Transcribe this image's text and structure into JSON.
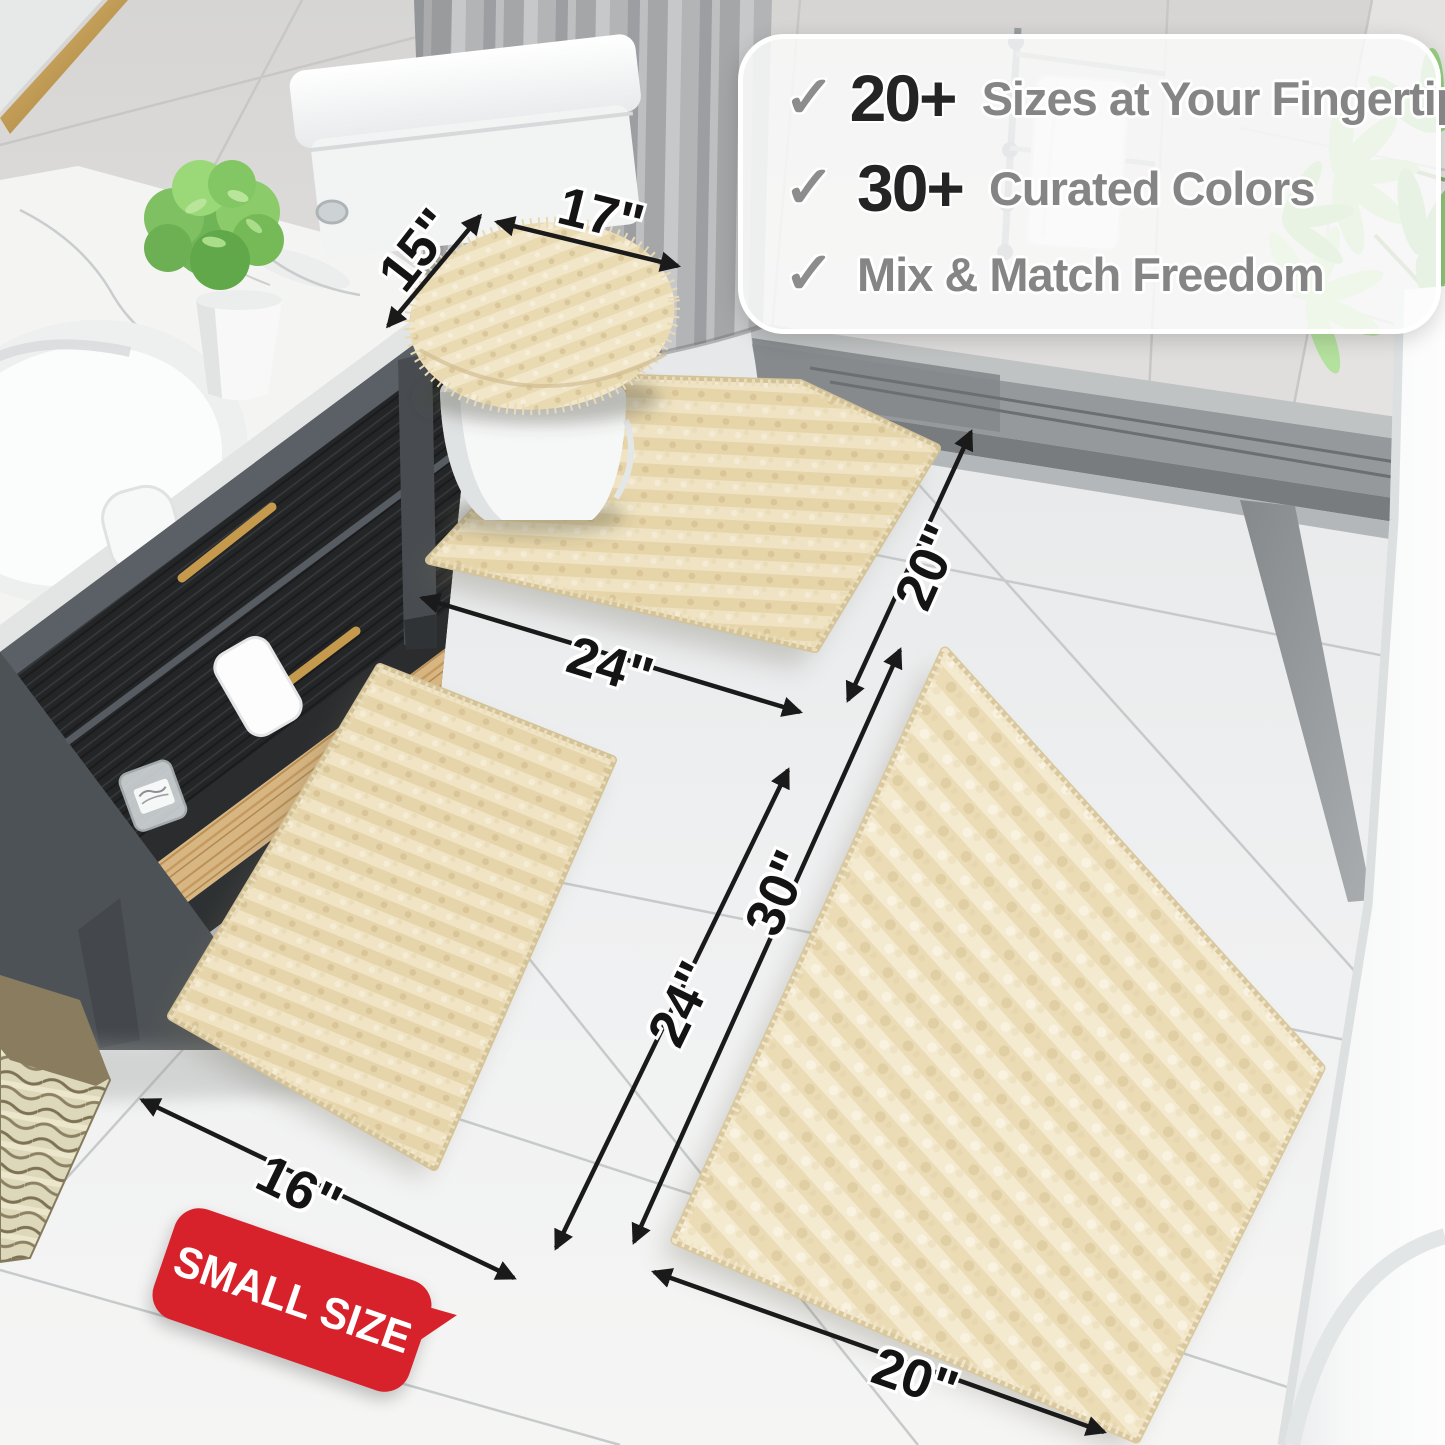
{
  "callout": {
    "items": [
      {
        "check": "✓",
        "value": "20+",
        "label": "Sizes at Your Fingertips"
      },
      {
        "check": "✓",
        "value": "30+",
        "label": "Curated Colors"
      },
      {
        "check": "✓",
        "value": "",
        "label": "Mix & Match Freedom"
      }
    ]
  },
  "dimensions": {
    "lid_width": "17\"",
    "lid_depth": "15\"",
    "contour_depth": "20\"",
    "contour_width": "24\"",
    "small_rug_length": "24\"",
    "small_rug_width": "16\"",
    "large_rug_length": "30\"",
    "large_rug_width": "20\""
  },
  "badge": {
    "label": "SMALL SIZE"
  },
  "colors": {
    "badge_red": "#d7222b",
    "rug_beige": "#e6d5aa",
    "label_ink": "#141414",
    "callout_gray": "#858585"
  }
}
